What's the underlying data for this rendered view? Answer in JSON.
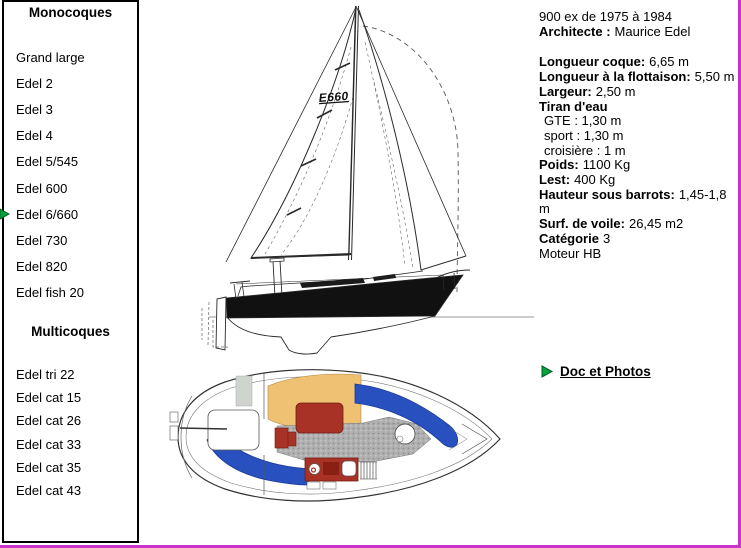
{
  "page": {
    "colors": {
      "frame_magenta": "#cc33cc",
      "marker_green": "#00a33e",
      "plan_blue": "#2850be",
      "plan_orange": "#efc173",
      "plan_red": "#a93226"
    }
  },
  "sidebar": {
    "sections": [
      {
        "title": "Monocoques",
        "items": [
          "Grand large",
          "Edel 2",
          "Edel 3",
          "Edel 4",
          "Edel 5/545",
          "Edel 600",
          "Edel 6/660",
          "Edel 730",
          "Edel 820",
          "Edel fish 20"
        ]
      },
      {
        "title": "Multicoques",
        "items": [
          "Edel tri 22",
          "Edel cat 15",
          "Edel cat 26",
          "Edel cat 33",
          "Edel cat 35",
          "Edel cat 43"
        ]
      }
    ],
    "selected_item": "Edel 6/660"
  },
  "specs": {
    "production": "900 ex de 1975 à 1984",
    "architect": {
      "label": "Architecte :",
      "value": "Maurice Edel"
    },
    "rows": [
      {
        "label": "Longueur coque:",
        "value": "6,65 m"
      },
      {
        "label": "Longueur à la flottaison:",
        "value": "5,50 m"
      },
      {
        "label": "Largeur:",
        "value": "2,50 m"
      },
      {
        "label": "Tiran d'eau",
        "value": ""
      },
      {
        "label": "",
        "value": "GTE : 1,30 m"
      },
      {
        "label": "",
        "value": "sport : 1,30 m"
      },
      {
        "label": "",
        "value": "croisière : 1 m"
      },
      {
        "label": "Poids:",
        "value": "1100 Kg"
      },
      {
        "label": "Lest:",
        "value": "400 Kg"
      },
      {
        "label": "Hauteur sous barrots:",
        "value": "1,45-1,8 m"
      },
      {
        "label": "Surf. de voile:",
        "value": "26,45 m2"
      },
      {
        "label": "Catégorie",
        "value": "3"
      },
      {
        "label": "",
        "value": "Moteur HB"
      }
    ],
    "doc_link": "Doc et Photos"
  },
  "drawings": {
    "sail_logo": "E660"
  }
}
